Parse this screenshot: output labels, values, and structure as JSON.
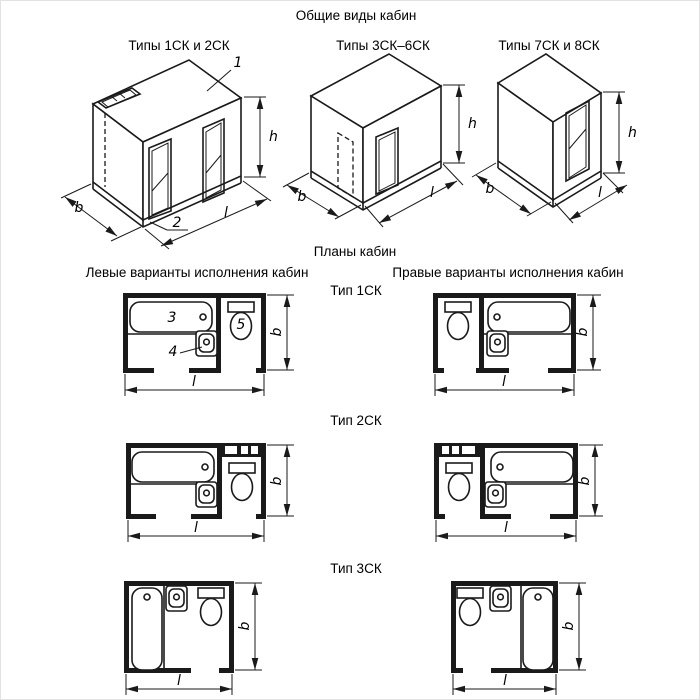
{
  "title": "Общие виды кабин",
  "views": [
    {
      "label": "Типы 1СК и 2СК"
    },
    {
      "label": "Типы 3СК–6СК"
    },
    {
      "label": "Типы 7СК и 8СК"
    }
  ],
  "plans": {
    "title": "Планы кабин",
    "left_header": "Левые варианты исполнения кабин",
    "right_header": "Правые варианты исполнения кабин",
    "types": [
      "Тип 1СК",
      "Тип 2СК",
      "Тип 3СК"
    ]
  },
  "dims": {
    "width": "b",
    "length": "l",
    "height": "h"
  },
  "callouts": {
    "roof": "1",
    "base": "2",
    "bath": "3",
    "sink": "4",
    "toilet": "5"
  },
  "colors": {
    "line": "#1a1a1a",
    "background": "#ffffff"
  }
}
